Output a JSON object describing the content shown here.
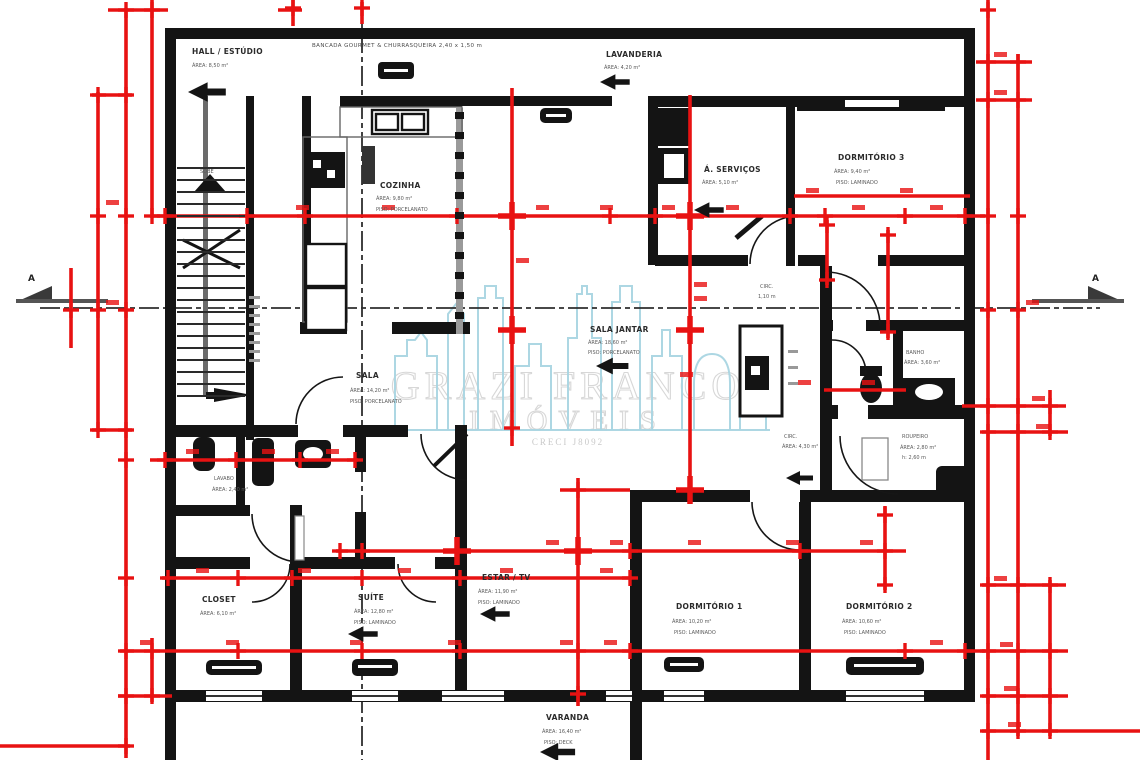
{
  "watermark": {
    "title": "GRAZI FRANCO",
    "subtitle": "IMÓVEIS",
    "creci": "CRECI J8092"
  },
  "section_markers": {
    "left": "A",
    "right": "A"
  },
  "notes": {
    "top": "BANCADA GOURMET & CHURRASQUEIRA  2,40 x 1,50 m",
    "stairs": "SOBE"
  },
  "rooms": {
    "hall": {
      "name": "HALL / ESTÚDIO",
      "l2": "ÁREA: 8,50 m²",
      "l3": ""
    },
    "cozinha": {
      "name": "COZINHA",
      "l2": "ÁREA: 9,80 m²",
      "l3": "PISO: PORCELANATO"
    },
    "lavanderia": {
      "name": "LAVANDERIA",
      "l2": "ÁREA: 4,20 m²",
      "l3": ""
    },
    "servicos": {
      "name": "Á. SERVIÇOS",
      "l2": "ÁREA: 5,10 m²",
      "l3": ""
    },
    "dorm3": {
      "name": "DORMITÓRIO 3",
      "l2": "ÁREA: 9,40 m²",
      "l3": "PISO: LAMINADO"
    },
    "circ_top": {
      "name": "CIRC.",
      "l2": "1,10 m",
      "l3": ""
    },
    "banho": {
      "name": "BANHO",
      "l2": "ÁREA: 3,60 m²",
      "l3": ""
    },
    "roupeiro": {
      "name": "ROUPEIRO",
      "l2": "ÁREA: 2,80 m²",
      "l3": "h: 2,60 m"
    },
    "circ2": {
      "name": "CIRC.",
      "l2": "ÁREA: 4,30 m²",
      "l3": ""
    },
    "jantar": {
      "name": "SALA JANTAR",
      "l2": "ÁREA: 18,60 m²",
      "l3": "PISO: PORCELANATO"
    },
    "sala": {
      "name": "SALA",
      "l2": "ÁREA: 14,20 m²",
      "l3": "PISO: PORCELANATO"
    },
    "lavabo": {
      "name": "LAVABO",
      "l2": "ÁREA: 2,40 m²",
      "l3": ""
    },
    "closet": {
      "name": "CLOSET",
      "l2": "ÁREA: 6,10 m²",
      "l3": ""
    },
    "suite": {
      "name": "SUÍTE",
      "l2": "ÁREA: 12,80 m²",
      "l3": "PISO: LAMINADO"
    },
    "estar": {
      "name": "ESTAR / TV",
      "l2": "ÁREA: 11,90 m²",
      "l3": "PISO: LAMINADO"
    },
    "dorm1": {
      "name": "DORMITÓRIO 1",
      "l2": "ÁREA: 10,20 m²",
      "l3": "PISO: LAMINADO"
    },
    "dorm2": {
      "name": "DORMITÓRIO 2",
      "l2": "ÁREA: 10,60 m²",
      "l3": "PISO: LAMINADO"
    },
    "varanda": {
      "name": "VARANDA",
      "l2": "ÁREA: 16,40 m²",
      "l3": "PISO: DECK"
    }
  },
  "colors": {
    "dimension_red": "#e81212",
    "wall_black": "#141414",
    "watermark_blue": "#a9d5e2"
  }
}
